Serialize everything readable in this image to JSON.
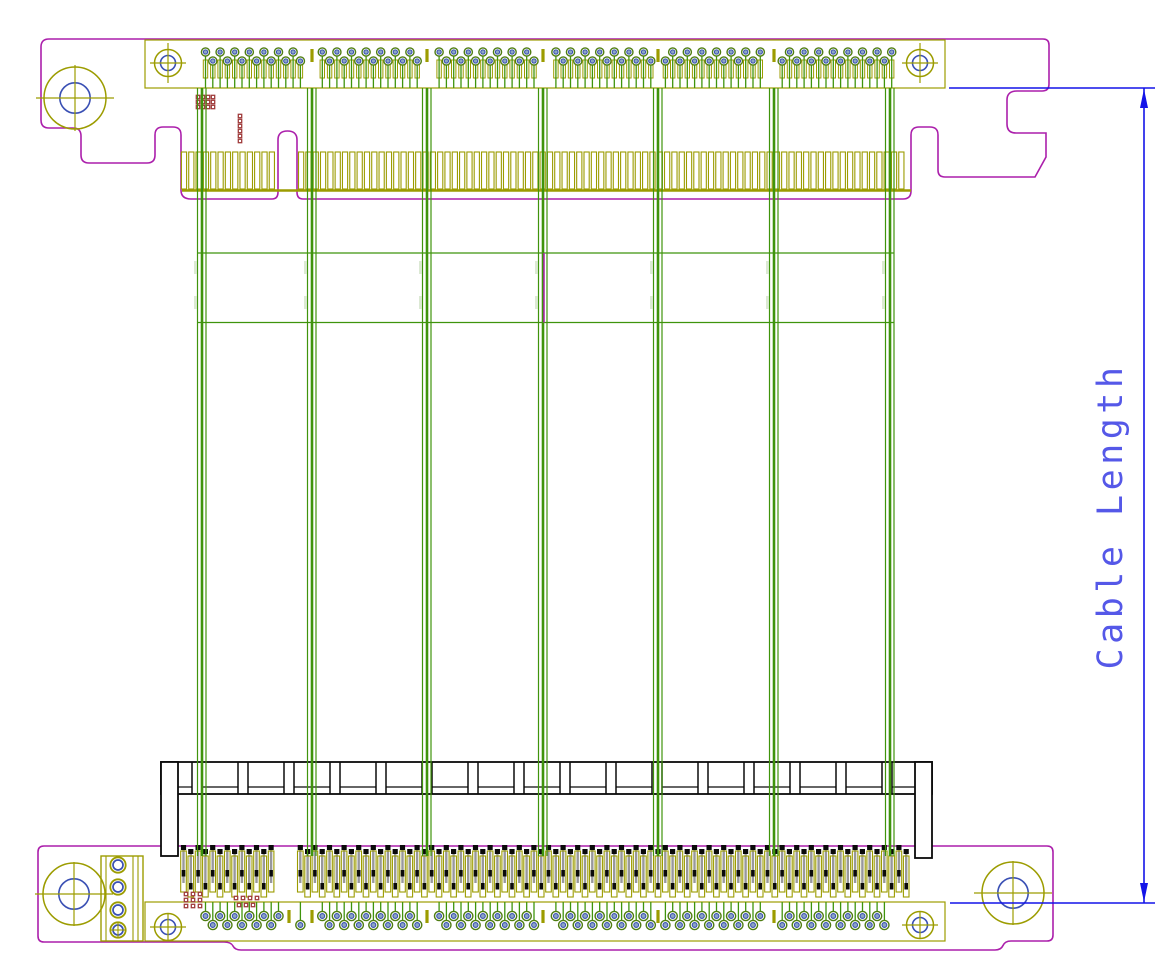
{
  "annotation": {
    "cable_length_label": "Cable Length"
  },
  "drawing": {
    "width": 1173,
    "height": 961,
    "colors": {
      "outline": "#AB1FAB",
      "copper": "#9C9C00",
      "cable": "#3F940C",
      "cablePale": "#DCE9D4",
      "dim": "#1414E8",
      "dimText": "#5558E8",
      "drill": "#3A50B4",
      "padRing": "#4F7D12",
      "padFill": "#8CA6C2",
      "via": "#A03C3C",
      "black": "#0A0A0A",
      "gray": "#98989C",
      "white": "#FFFFFF"
    },
    "cables": {
      "x": [
        202,
        312,
        427,
        543,
        658,
        774,
        890
      ],
      "yTop": 88,
      "yBottom": 856,
      "railY": [
        253,
        322.5
      ],
      "railX1": 197,
      "railX2": 894,
      "magentaSegX": 544
    },
    "topBoard": {
      "outline": "M49 39 H1043 Q1049 39 1049 45 V84 Q1049 91 1042 91 H1017 Q1007 91 1007 100 V124 Q1007 133 1016 133 H1046 V157 L1035 177 H945 Q938 177 938 170 V135 Q938 127 930 127 H919 Q911 127 911 135 V191 Q911 199 903 199 H303 Q297 199 297 192 V140 Q297 131 287.5 131 Q278 131 278 140 V192 Q278 199 272 199 H191 Q181 199 181 190 V135 Q181 127 173 127 H163 Q155 127 155 135 V155 Q155 163 147 163 H89 Q81 163 81 155 V136 Q81 128 73 128 H49 Q41 128 41 120 V47 Q41 39 49 39 Z",
      "band": [
        145,
        40,
        945,
        88
      ],
      "largeHoles": [
        [
          75,
          98
        ]
      ],
      "smallHoles": [
        [
          168,
          63
        ],
        [
          920,
          63
        ]
      ],
      "fingers": {
        "x1": 184,
        "x2": 908,
        "yTop": 152,
        "h": 37,
        "pitch": 7.32,
        "w": 5.2,
        "keyGap": [
          277,
          297
        ],
        "baseY": 190.5
      },
      "pads": {
        "x1": 205.5,
        "x2": 893,
        "pitch": 7.3,
        "cyA": 52,
        "cyB": 61,
        "stemY": 88,
        "rectY": 60,
        "rectH": 18,
        "gaps": [
          312,
          427,
          543,
          658,
          774
        ],
        "tickY": 49
      },
      "vias": [
        [
          198,
          97
        ],
        [
          203,
          97
        ],
        [
          208,
          97
        ],
        [
          213,
          97
        ],
        [
          198,
          102
        ],
        [
          203,
          102
        ],
        [
          208,
          102
        ],
        [
          213,
          102
        ],
        [
          198,
          107
        ],
        [
          203,
          107
        ],
        [
          208,
          107
        ],
        [
          213,
          107
        ],
        [
          240,
          116
        ],
        [
          240,
          121
        ],
        [
          240,
          126
        ],
        [
          240,
          131
        ],
        [
          240,
          136
        ],
        [
          240,
          141
        ]
      ]
    },
    "bottomBoard": {
      "outline": "M44 846 H1047 Q1053 846 1053 852 V935 Q1053 941 1047 941 H1011 Q1005 941 1003 945.5 Q1001 950 995 950 H241 Q235 950 233 946 Q231 942 224 942 H44 Q38 942 38 936 V852 Q38 846 44 846 Z",
      "band": [
        145,
        902,
        945,
        941
      ],
      "largeHoles": [
        [
          74,
          894
        ],
        [
          1013,
          893
        ]
      ],
      "smallHoles": [
        [
          168,
          927
        ],
        [
          920,
          925
        ]
      ],
      "connector": {
        "x1": 161,
        "x2": 932,
        "yTop": 762,
        "yBot": 794,
        "ledgeY": 787,
        "wallW": 17,
        "wallBotL": 856,
        "wallBotR": 858,
        "postStart": 197,
        "postPitch": 46,
        "postHalf": 5
      },
      "pins": {
        "x1": 183.5,
        "x2": 913,
        "pitch": 7.3,
        "keyGap": [
          277,
          298
        ]
      },
      "pads": {
        "x1": 205.5,
        "x2": 890,
        "pitch": 7.3,
        "cyA": 916,
        "cyB": 925,
        "stemY": 902,
        "gaps": [
          312,
          427,
          543,
          658,
          774
        ],
        "keyGapCenter": 289,
        "tickY": 910
      },
      "power": {
        "x": 101,
        "y": 856,
        "w": 42,
        "h": 85,
        "innerX1": 106,
        "innerX2": 133,
        "innerX3": 138,
        "pinCx": 118,
        "pinCy": [
          865,
          887,
          910,
          930
        ]
      },
      "vias": [
        [
          186,
          894
        ],
        [
          193,
          894
        ],
        [
          200,
          894
        ],
        [
          186,
          900
        ],
        [
          193,
          900
        ],
        [
          200,
          900
        ],
        [
          186,
          906
        ],
        [
          193,
          906
        ],
        [
          200,
          906
        ],
        [
          236,
          898
        ],
        [
          243,
          898
        ],
        [
          250,
          898
        ],
        [
          257,
          898
        ],
        [
          239,
          905
        ],
        [
          246,
          905
        ],
        [
          253,
          905
        ]
      ]
    },
    "dimension": {
      "x": 1144,
      "y1": 88,
      "y2": 903,
      "extTop": [
        949,
        1155,
        88
      ],
      "extBot": [
        950,
        1155,
        903
      ],
      "textX": 1122,
      "textY": 516,
      "fontSize": 35,
      "letterSpacing": 4.5
    }
  }
}
